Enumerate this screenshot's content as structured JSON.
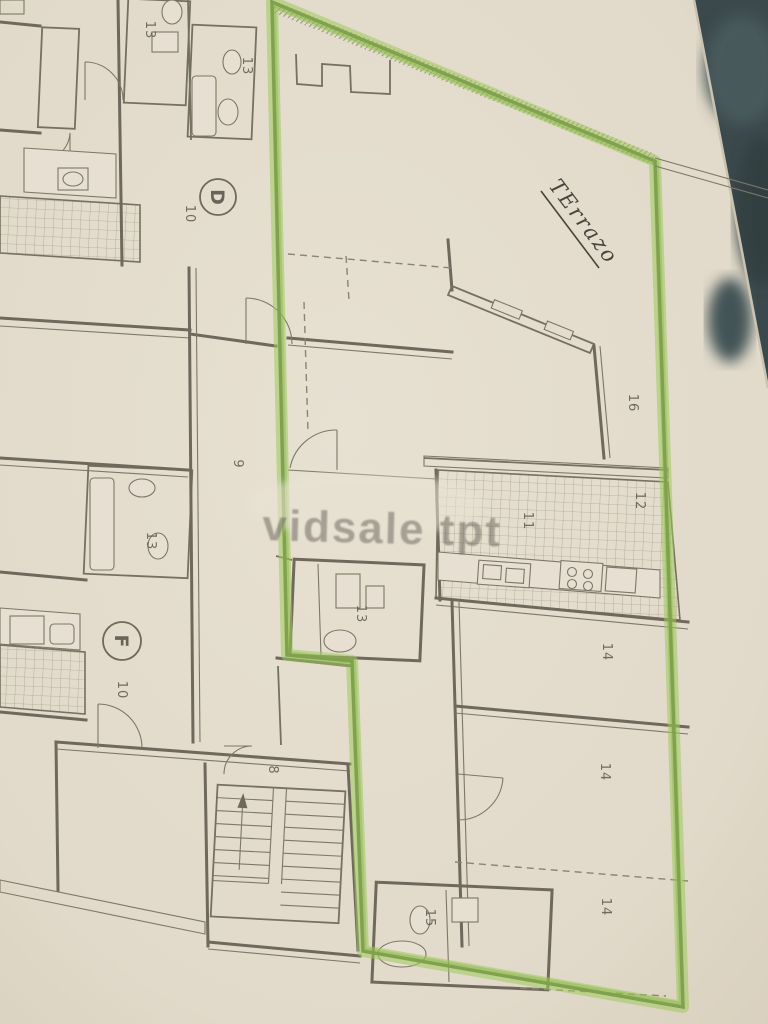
{
  "photo": {
    "handwritten_note": "TErrazo",
    "watermark": "vidsale tpt",
    "units": [
      {
        "letter": "D",
        "area_label": "10"
      },
      {
        "letter": "F",
        "area_label": "10"
      }
    ],
    "room_numbers": [
      "13",
      "13",
      "10",
      "9",
      "13",
      "10",
      "16",
      "11",
      "12",
      "13",
      "14",
      "14",
      "14",
      "8",
      "15"
    ],
    "colors": {
      "paper": "#e9e3d4",
      "highlighter": "#9fce5a",
      "ink": "#6e695d",
      "backdrop": "#37474b"
    }
  }
}
